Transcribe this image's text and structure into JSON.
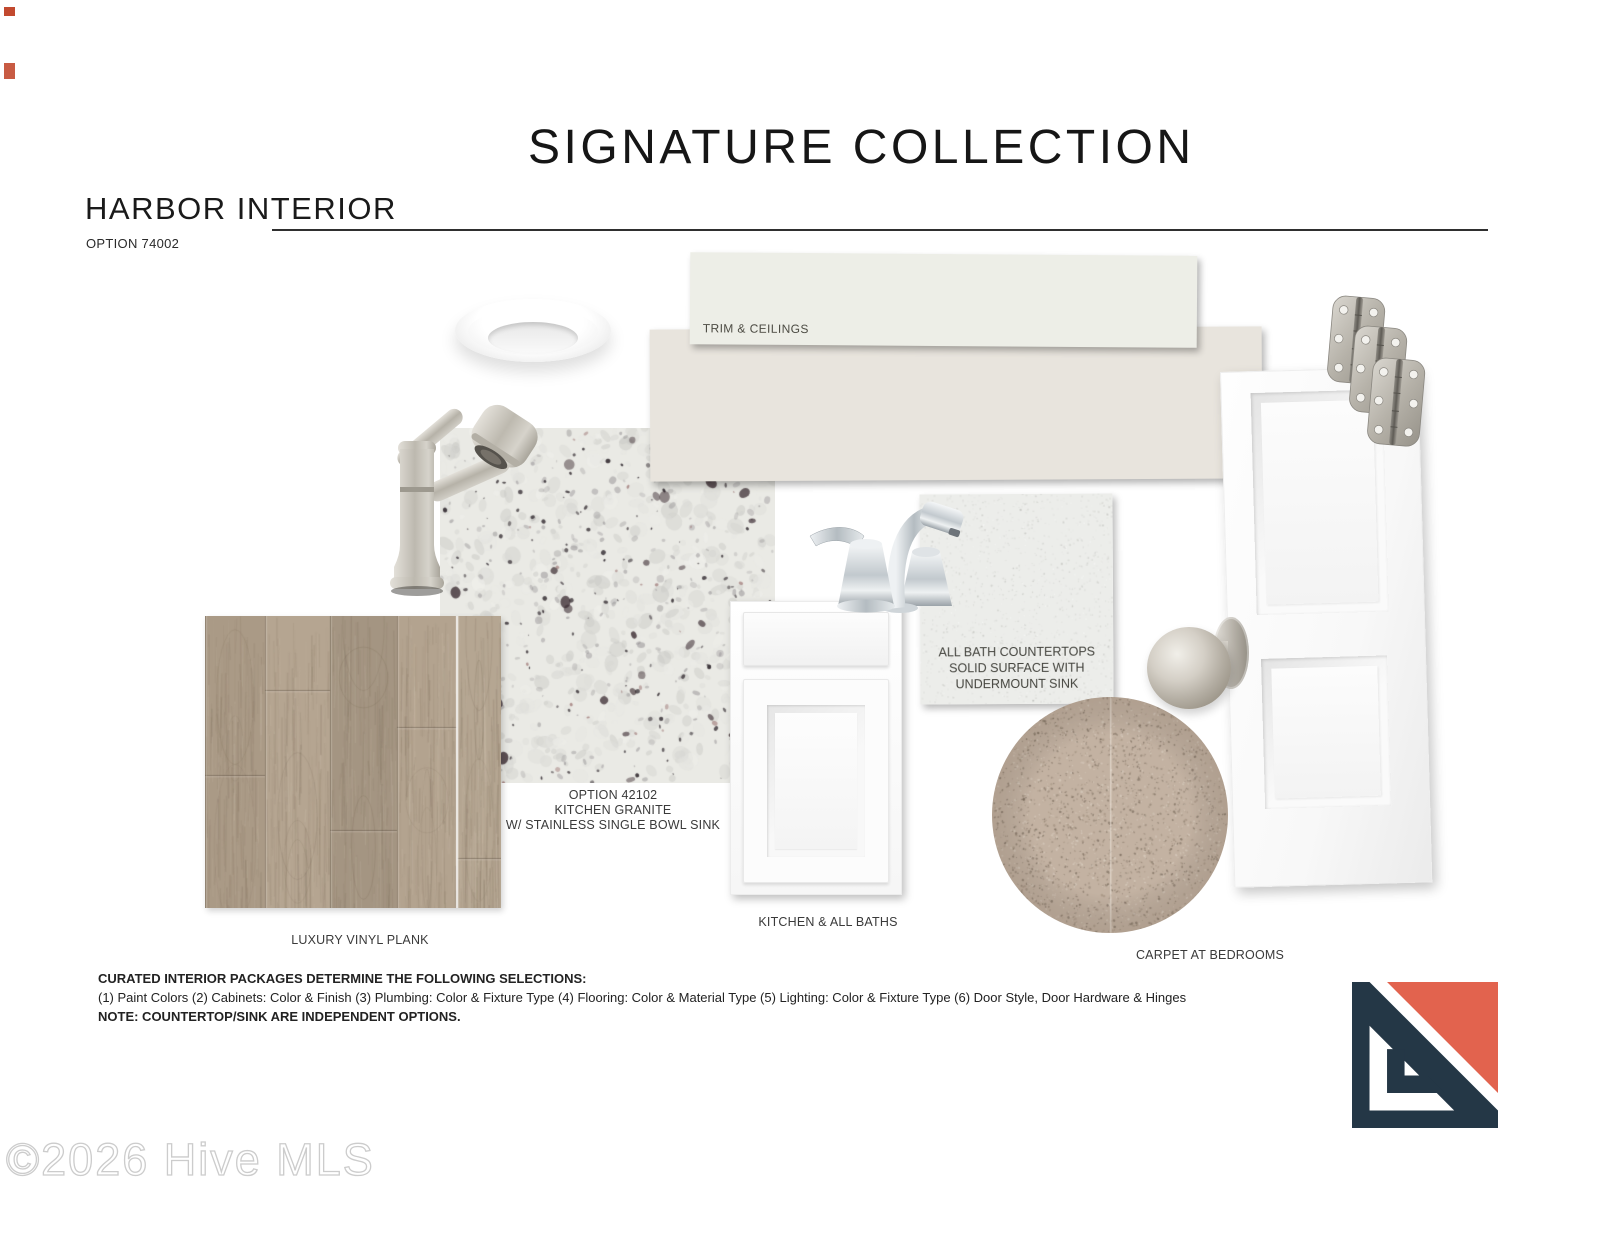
{
  "header": {
    "title": "SIGNATURE COLLECTION",
    "collection_name": "HARBOR INTERIOR",
    "option_number": "OPTION 74002"
  },
  "samples": {
    "paint_trim": {
      "label": "TRIM & CEILINGS",
      "color": "#edeee7"
    },
    "paint_wall": {
      "color": "#e8e4dd"
    },
    "kitchen_granite": {
      "label": "OPTION 42102\nKITCHEN GRANITE\nW/ STAINLESS SINGLE BOWL SINK",
      "base_color": "#eaeae5"
    },
    "bath_countertop": {
      "label": "ALL BATH COUNTERTOPS\nSOLID SURFACE WITH\nUNDERMOUNT SINK",
      "base_color": "#ecedea"
    },
    "cabinet": {
      "label": "KITCHEN & ALL BATHS"
    },
    "vinyl_flooring": {
      "label": "LUXURY VINYL PLANK",
      "color": "#b1a18c"
    },
    "carpet": {
      "label": "CARPET AT BEDROOMS",
      "color": "#c3b2a2"
    },
    "kitchen_faucet_finish": "#c7c3ba",
    "bath_faucet_finish": "#d8dcdf"
  },
  "footer": {
    "heading": "CURATED INTERIOR PACKAGES DETERMINE THE FOLLOWING SELECTIONS:",
    "selections": "(1)  Paint Colors  (2) Cabinets: Color & Finish (3) Plumbing: Color & Fixture Type  (4) Flooring: Color & Material Type  (5) Lighting: Color & Fixture Type  (6) Door Style, Door Hardware & Hinges",
    "note": "NOTE:  COUNTERTOP/SINK ARE INDEPENDENT OPTIONS."
  },
  "watermark": "©2026 Hive MLS",
  "brand_colors": {
    "coral": "#e2634e",
    "navy": "#243746"
  }
}
